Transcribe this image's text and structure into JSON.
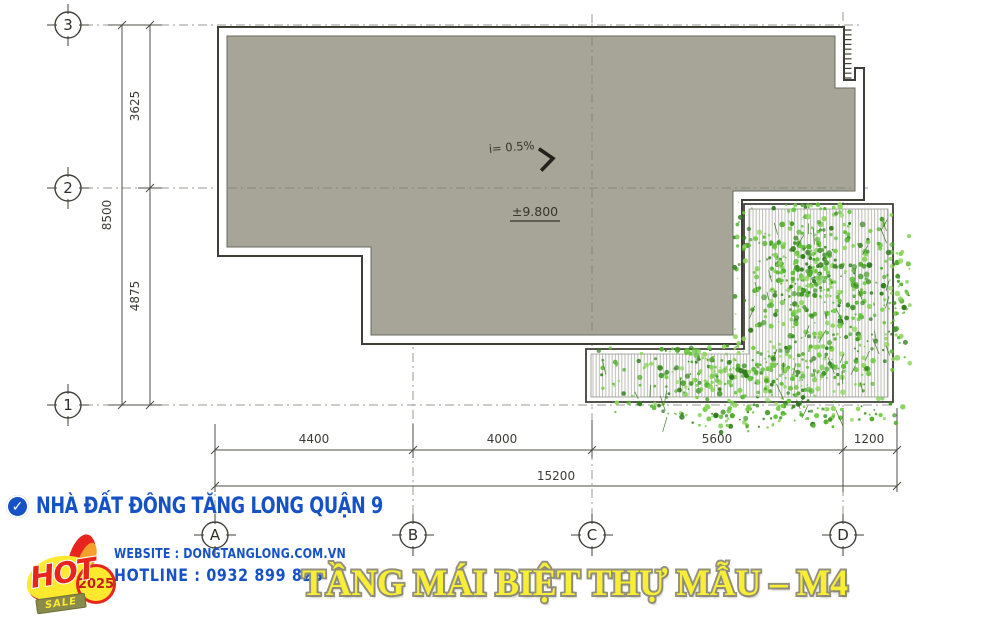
{
  "drawing": {
    "grid_rows": [
      {
        "label": "3"
      },
      {
        "label": "2"
      },
      {
        "label": "1"
      }
    ],
    "grid_cols": [
      {
        "label": "A"
      },
      {
        "label": "B"
      },
      {
        "label": "C"
      },
      {
        "label": "D"
      }
    ],
    "vertical_dims": {
      "segments": [
        "3625",
        "4875"
      ],
      "total": "8500"
    },
    "horizontal_dims": {
      "segments": [
        "4400",
        "4000",
        "5600",
        "1200"
      ],
      "total": "15200"
    },
    "annotations": {
      "slope": "i= 0.5%",
      "level": "±9.800"
    }
  },
  "footer": {
    "agency": "NHÀ ĐẤT ĐÔNG TĂNG LONG QUẬN 9",
    "website": "WEBSITE : DONGTANGLONG.COM.VN",
    "hotline": "HOTLINE : 0932 899 823",
    "title": "TẦNG MÁI BIỆT THỰ MẪU – M4",
    "badge": {
      "hot": "HOT",
      "sale": "SALE",
      "year": "2025"
    }
  },
  "colors": {
    "brand_blue": "#1652c6",
    "title_yellow": "#f7ee35",
    "roof_gray": "#a6a597",
    "foliage_green": "#4fae2b",
    "badge_red": "#e8251c"
  }
}
